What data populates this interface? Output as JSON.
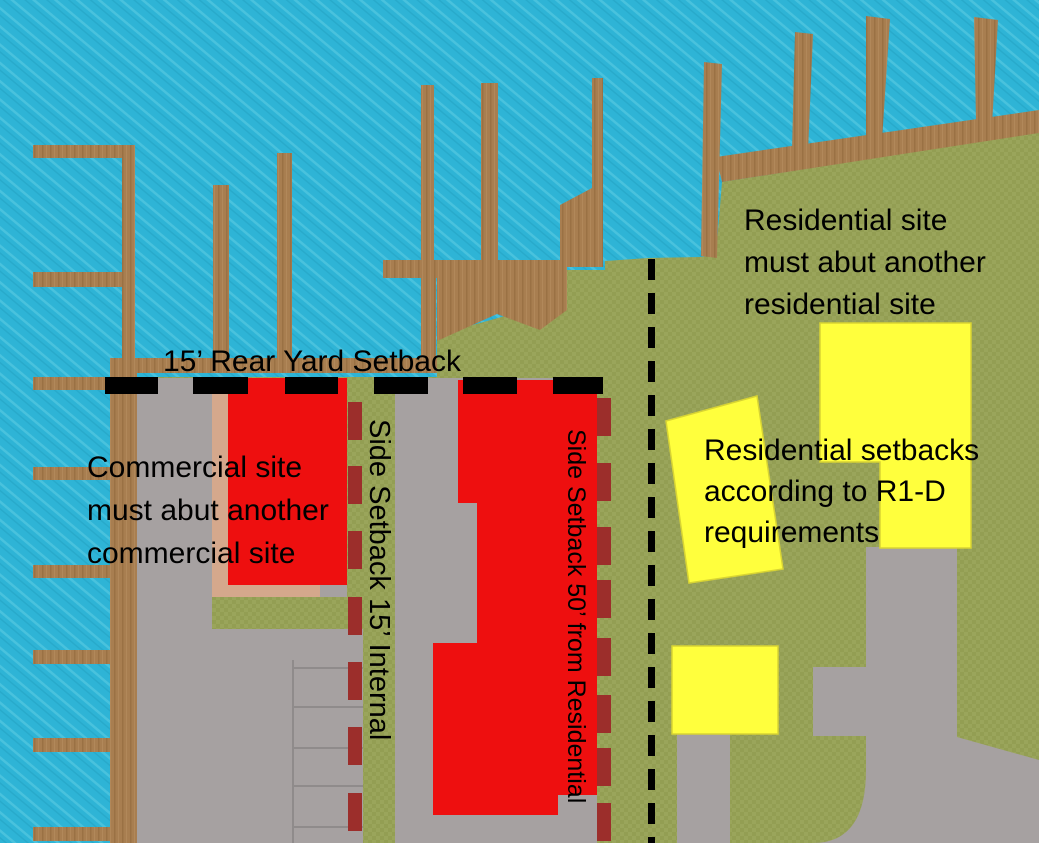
{
  "diagram": {
    "type": "waterfront-zoning-site-plan",
    "annotations": {
      "rear_yard_setback": "15’ Rear Yard Setback",
      "commercial_rule_lines": [
        "Commercial site",
        "must abut another",
        "commercial site"
      ],
      "residential_rule_lines": [
        "Residential site",
        "must abut another",
        "residential site"
      ],
      "residential_setback_lines": [
        "Residential setbacks",
        "according to R1-D",
        "requirements"
      ],
      "side_setback_internal": "Side Setback 15’ Internal",
      "side_setback_residential": "Side Setback 50’ from Residential"
    },
    "palette": {
      "water": "#2eb4d6",
      "land": "#9aa55b",
      "dock_wood": "#a87e50",
      "pavement": "#a6a1a1",
      "commercial_building": "#ee0f0f",
      "residential_building": "#ffff3d",
      "slip_marker": "#9c2e2b",
      "beach_strip": "#d5a88c",
      "setback_marker": "#000000"
    }
  }
}
